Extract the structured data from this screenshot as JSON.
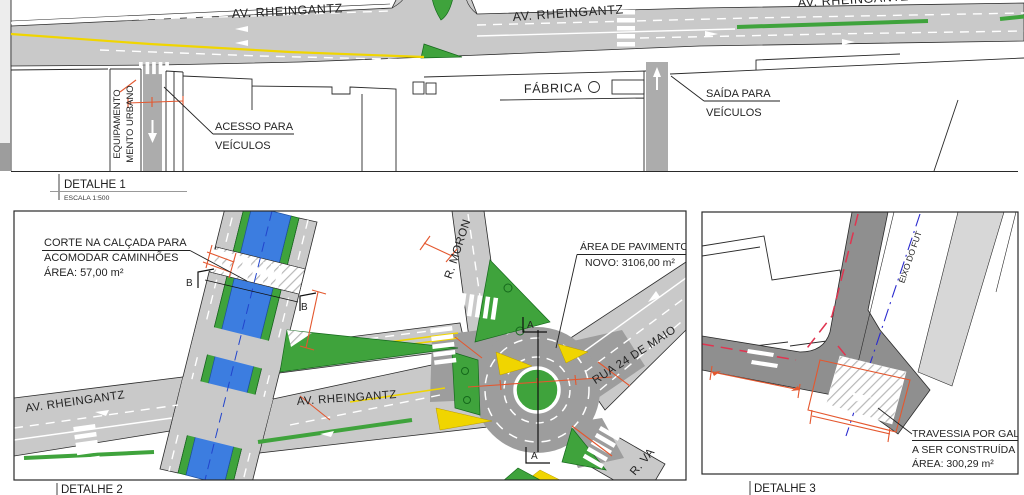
{
  "colors": {
    "road_light": "#c9c9c9",
    "road_dark": "#9d9d9d",
    "road_detail3": "#8f8f8f",
    "green": "#3fa33c",
    "canal_blue": "#3c7de0",
    "marking_yellow": "#f0d500",
    "dimension_orange": "#e4572e",
    "centerline_red": "#e03450",
    "axis_blue": "#2b2bcf",
    "line_black": "#2a2a2a"
  },
  "detail1": {
    "title": "DETALHE 1",
    "scale": "ESCALA 1:500",
    "street_left": "AV. RHEINGANTZ",
    "street_center": "AV. RHEINGANTZ",
    "street_right": "AV. RHEINGANTZ",
    "factory_label": "FÁBRICA",
    "access_note": [
      "ACESSO PARA",
      "VEÍCULOS"
    ],
    "exit_note": [
      "SAÍDA PARA",
      "VEÍCULOS"
    ],
    "equipment_note": [
      "EQUIPAMENTO",
      "MENTO URBANO"
    ]
  },
  "detail2": {
    "title": "DETALHE 2",
    "curb_cut_note": [
      "CORTE NA CALÇADA PARA",
      "ACOMODAR CAMINHÕES",
      "ÁREA: 57,00 m²"
    ],
    "pavement_note": [
      "ÁREA DE PAVIMENTO",
      "NOVO: 3106,00 m²"
    ],
    "street_av_left": "AV. RHEINGANTZ",
    "street_av_right": "AV. RHEINGANTZ",
    "street_moron": "R. MORON",
    "street_24maio": "RUA 24 DE MAIO",
    "street_va": "R. VA",
    "section_a": "A",
    "section_b": "B"
  },
  "detail3": {
    "title": "DETALHE 3",
    "axis_label": "EIXO DO FUT",
    "crossing_note": [
      "TRAVESSIA POR GALE",
      "A SER CONSTRUÍDA",
      "ÁREA: 300,29 m²"
    ]
  }
}
